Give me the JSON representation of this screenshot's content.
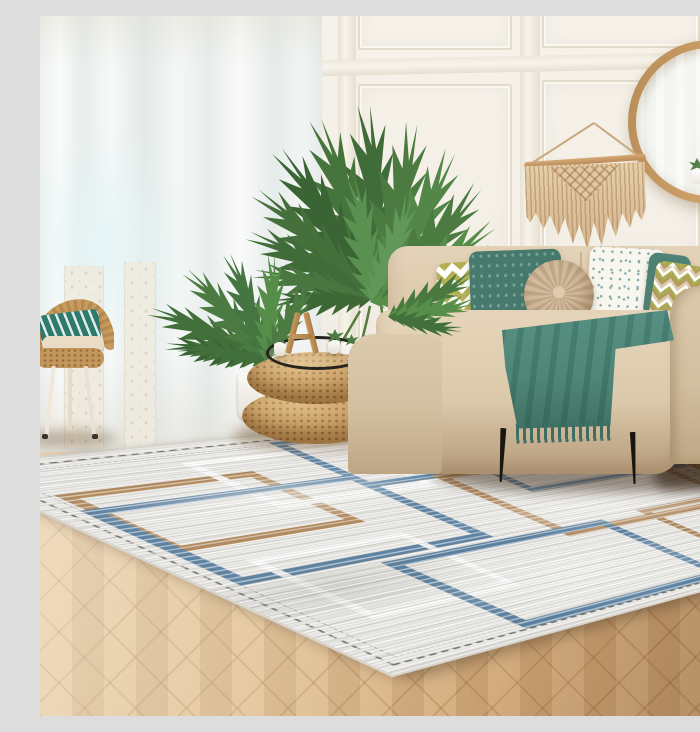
{
  "image": {
    "kind": "photograph",
    "label": "Scandinavian living room with distressed geometric area rug",
    "width_px": 700,
    "height_px": 700
  },
  "palette": {
    "wall": "#f4f0e7",
    "molding": "#e2dccd",
    "curtain": "#eef2f0",
    "floor_light": "#e6cda5",
    "floor_dark": "#a9793f",
    "sofa": "#d9c6ab",
    "teal": "#4e8577",
    "chevron_green": "#b3ae52",
    "rug_background": "#edece8",
    "rug_blue": "#5b83a6",
    "rug_tan": "#b78c5c",
    "rug_white": "#ffffff",
    "rattan": "#c59a60",
    "mirror_frame": "#c79a62",
    "macrame": "#ddc29e",
    "plant_green": "#49793f",
    "sofa_leg_black": "#1a1510"
  },
  "scene": {
    "wall": {
      "label": "white wainscot panel wall"
    },
    "mirror": {
      "label": "round wood-framed wall mirror with reflected curtain and two small potted plants"
    },
    "macrame": {
      "label": "beige macrame wall hanging on wooden dowel"
    },
    "curtains": {
      "label": "sheer white floor-length curtains with lace under-panels"
    },
    "chair": {
      "label": "rattan chair with teal patterned pillow and beige seat cushion"
    },
    "plant": {
      "label": "areca palm houseplant"
    },
    "poufs": {
      "label": "two stacked woven rattan poufs"
    },
    "tray": {
      "label": "black wire tray with succulent pots and wooden letter-A stand"
    },
    "pots": {
      "label": "white ceramic planters"
    },
    "sofa": {
      "label": "beige fabric loveseat on black metal legs",
      "pillows": [
        {
          "label": "chevron pillow",
          "pattern": "zigzag",
          "colors": [
            "#b3ae52",
            "#ffffff"
          ]
        },
        {
          "label": "teal motif pillow",
          "pattern": "small leaf print",
          "colors": [
            "#47796d"
          ]
        },
        {
          "label": "round pleated pillow",
          "pattern": "radial pleats",
          "colors": [
            "#cdb59a"
          ]
        },
        {
          "label": "speckled pillow",
          "pattern": "speckles",
          "colors": [
            "#f7f6ef",
            "#7fa89b"
          ]
        },
        {
          "label": "plain teal pillow",
          "pattern": "solid",
          "colors": [
            "#4d8276"
          ]
        },
        {
          "label": "chevron pillow",
          "pattern": "zigzag",
          "colors": [
            "#a9a952",
            "#b98e5e",
            "#ffffff"
          ]
        }
      ],
      "throw": {
        "label": "teal fringed throw blanket"
      }
    },
    "floor": {
      "label": "herringbone oak parquet floor"
    },
    "rug": {
      "label": "distressed geometric area rug",
      "pattern": "overlapping open rectangles",
      "accent_colors": [
        "#5b83a6",
        "#b78c5c",
        "#ffffff"
      ],
      "border": "double dashed charcoal border lines"
    }
  }
}
